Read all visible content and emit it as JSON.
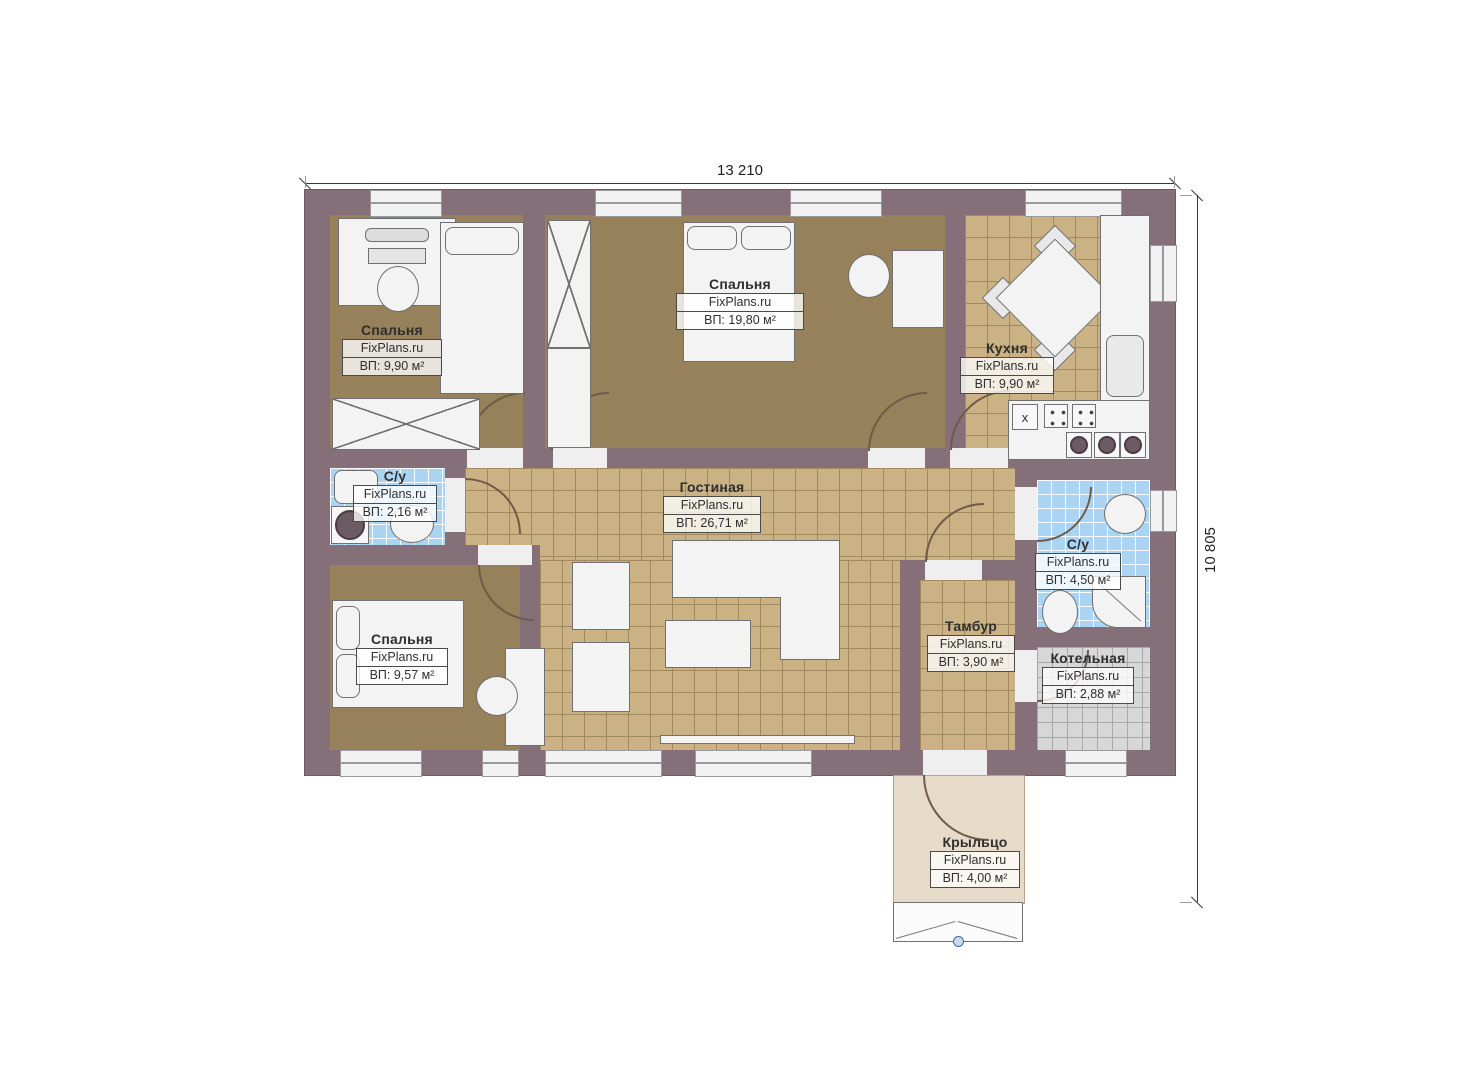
{
  "plan": {
    "watermark": "FixPlans.ru",
    "dimensions": {
      "width_label": "13 210",
      "height_label": "10 805"
    },
    "rooms": [
      {
        "id": "bedroom-top-left",
        "name": "Спальня",
        "area": "ВП: 9,90 м²"
      },
      {
        "id": "bedroom-top-middle",
        "name": "Спальня",
        "area": "ВП: 19,80 м²"
      },
      {
        "id": "kitchen",
        "name": "Кухня",
        "area": "ВП: 9,90 м²"
      },
      {
        "id": "bathroom-small",
        "name": "С/у",
        "area": "ВП: 2,16 м²"
      },
      {
        "id": "living-room",
        "name": "Гостиная",
        "area": "ВП: 26,71 м²"
      },
      {
        "id": "bathroom-large",
        "name": "С/у",
        "area": "ВП: 4,50 м²"
      },
      {
        "id": "bedroom-bottom-left",
        "name": "Спальня",
        "area": "ВП: 9,57 м²"
      },
      {
        "id": "tambour",
        "name": "Тамбур",
        "area": "ВП: 3,90 м²"
      },
      {
        "id": "boiler-room",
        "name": "Котельная",
        "area": "ВП: 2,88 м²"
      },
      {
        "id": "porch",
        "name": "Крыльцо",
        "area": "ВП: 4,00 м²"
      }
    ],
    "kitchen_marks": {
      "stove_mark": "x"
    },
    "colors": {
      "wall": "#857079",
      "bedroom_floor": "#96815a",
      "tile_floor": "#cab285",
      "bathroom_tile": "#abd4f3",
      "boiler_tile": "#d7d7d7",
      "porch_floor": "#e6dac8"
    }
  }
}
